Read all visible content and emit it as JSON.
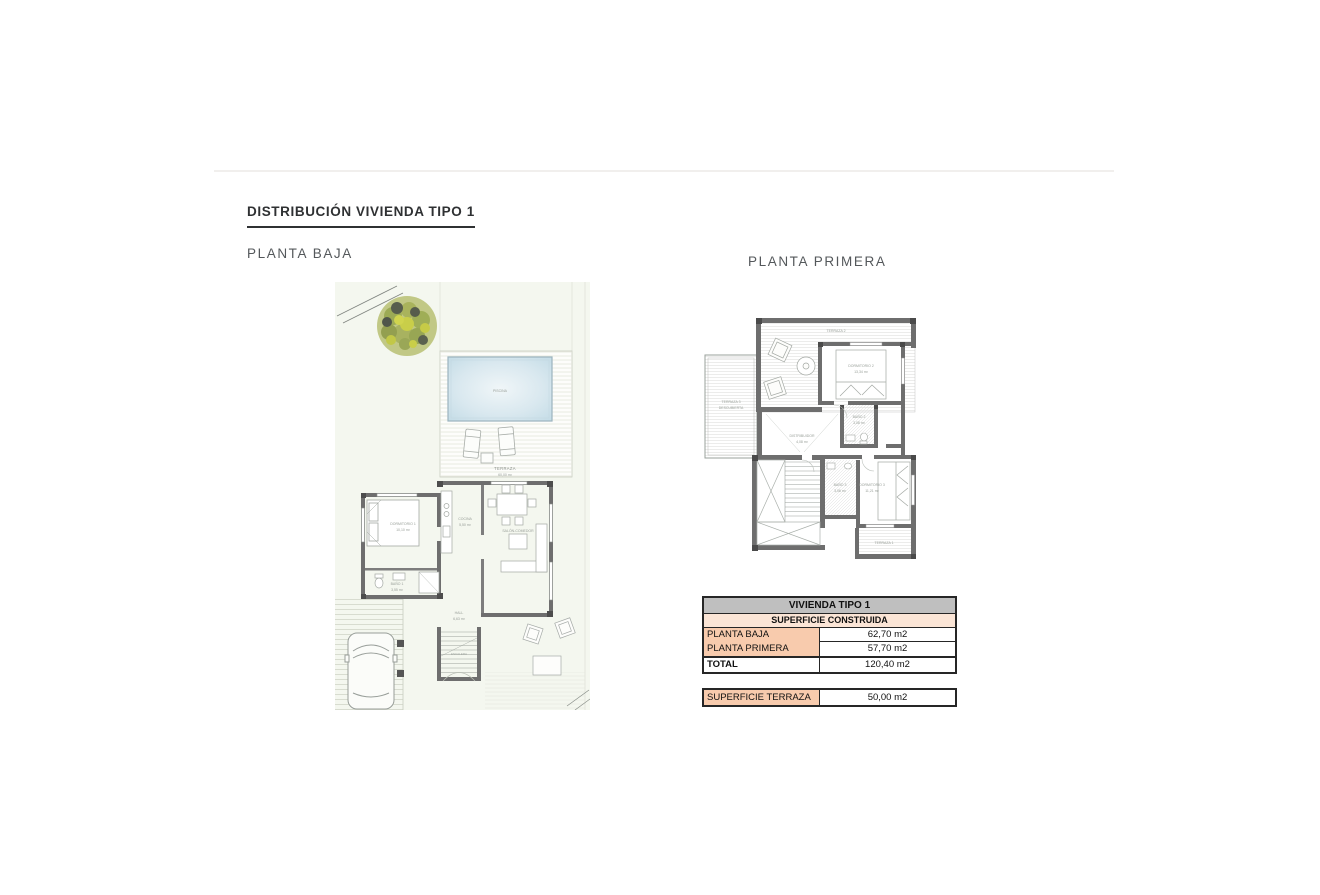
{
  "page": {
    "heading": "DISTRIBUCIÓN VIVIENDA TIPO 1",
    "plan_left_label": "PLANTA BAJA",
    "plan_right_label": "PLANTA PRIMERA"
  },
  "pb": {
    "piscina": "PISCINA",
    "terraza": "TERRAZA",
    "terraza_area": "60,00 m²",
    "dormitorio1": "DORMITORIO 1",
    "dormitorio1_area": "10,10 m²",
    "bano1": "BAÑO 1",
    "bano1_area": "3,55 m²",
    "cocina": "COCINA",
    "cocina_area": "5,50 m²",
    "salon": "SALÓN-COMEDOR",
    "salon_area": "19,55 m²",
    "hall": "HALL",
    "hall_area": "6,63 m²",
    "escalera": "ESCALERA"
  },
  "pp": {
    "terraza2": "TERRAZA 2",
    "terraza3_l1": "TERRAZA 3",
    "terraza3_l2": "DESCUBIERTA",
    "dormitorio2": "DORMITORIO 2",
    "dormitorio2_area": "13,34 m²",
    "bano2": "BAÑO 2",
    "bano2_area": "3,08 m²",
    "distribuidor": "DISTRIBUIDOR",
    "distribuidor_area": "4,08 m²",
    "bano3": "BAÑO 3",
    "bano3_area": "3,06 m²",
    "dormitorio3": "DORMITORIO 3",
    "dormitorio3_area": "11,21 m²",
    "terraza1": "TERRAZA 1"
  },
  "table": {
    "title": "VIVIENDA TIPO 1",
    "subtitle": "SUPERFICIE CONSTRUIDA",
    "rows": [
      {
        "label": "PLANTA BAJA",
        "value": "62,70 m2"
      },
      {
        "label": "PLANTA PRIMERA",
        "value": "57,70 m2"
      },
      {
        "label": "TOTAL",
        "value": "120,40 m2"
      }
    ],
    "terrace": {
      "label": "SUPERFICIE TERRAZA",
      "value": "50,00 m2"
    }
  },
  "colors": {
    "table_header_gray": "#bfbfbf",
    "table_peach_light": "#fbe5d6",
    "table_peach": "#f8cbad",
    "table_border": "#262626",
    "pool_blue": "#cfe2ec",
    "plan_ground_green": "#f4f7ef",
    "wall_gray": "#6e6e6e",
    "heading_dark": "#2f3133"
  }
}
